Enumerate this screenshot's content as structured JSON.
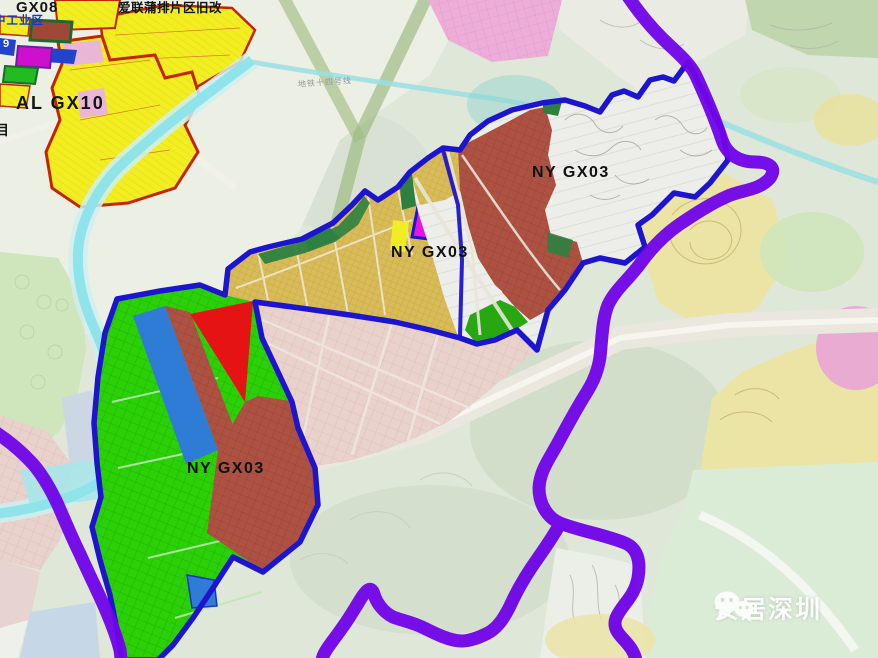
{
  "map": {
    "labels": {
      "gx08": "GX08",
      "ailian_renewal": "爱联蒲排片区旧改",
      "industrial_area": "中工业区",
      "al_gx10": "AL GX10",
      "partial_char": "目",
      "parcel_digit": "9",
      "metro_line": "地铁十四号线",
      "ny_gx03_upper": "NY GX03",
      "ny_gx03_middle": "NY GX03",
      "ny_gx03_lower": "NY GX03"
    },
    "watermark": {
      "text": "安居深圳",
      "icon": "wechat-logo"
    },
    "colors": {
      "zoneBorderBlue": "#1c14cf",
      "boundaryPurple": "#7005e8",
      "riverCyan": "#8fe3ea",
      "parcelGreen": "#2bd007",
      "parcelDarkRed": "#ad5242",
      "parcelRed": "#e51313",
      "parcelMagenta": "#e318e0",
      "parcelBlue": "#2e7cd6",
      "parcelTan": "#d8bc5a",
      "parcelYellow": "#f2ee22",
      "redOutline": "#c62400",
      "pinkDistrict": "#e8d2cb"
    }
  }
}
